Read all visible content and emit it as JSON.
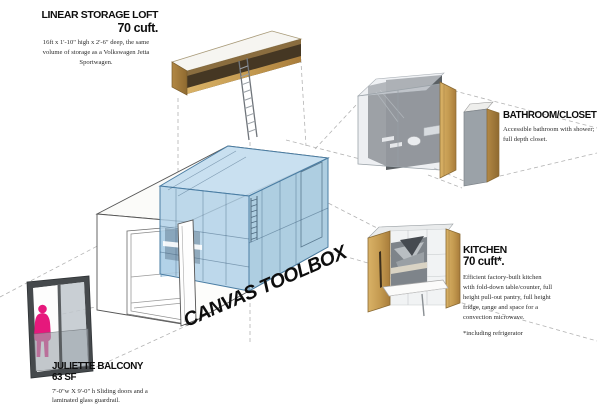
{
  "central_label": "CANVAS TOOLBOX",
  "callouts": {
    "storage_loft": {
      "title": "LINEAR STORAGE LOFT",
      "volume": "70 cuft.",
      "description": "16ft x 1'-10\" high x 2'-6\" deep, the same volume of storage as a Volkswagen Jetta Sportwagen."
    },
    "bathroom_closet": {
      "title": "BATHROOM/CLOSET",
      "description": "Accessible bathroom with shower; full depth closet."
    },
    "kitchen": {
      "title": "KITCHEN",
      "volume": "70 cuft*.",
      "description": "Efficient factory-built kitchen with fold-down table/counter, full height pull-out pantry, full height fridge, range and space for a convection microwave.",
      "footnote": "*including refrigerator"
    },
    "juliette_balcony": {
      "title": "JULIETTE BALCONY",
      "area": "63 SF",
      "description": "7'-0\"w X 9'-0\" h Sliding doors and a laminated glass guardrail."
    }
  },
  "colors": {
    "highlight_blue": "#aed0e6",
    "blue_edge": "#4a7da3",
    "wood": "#c49a50",
    "figure_pink": "#e6187c",
    "leader_line": "#b3b3b3",
    "text": "#101010"
  }
}
